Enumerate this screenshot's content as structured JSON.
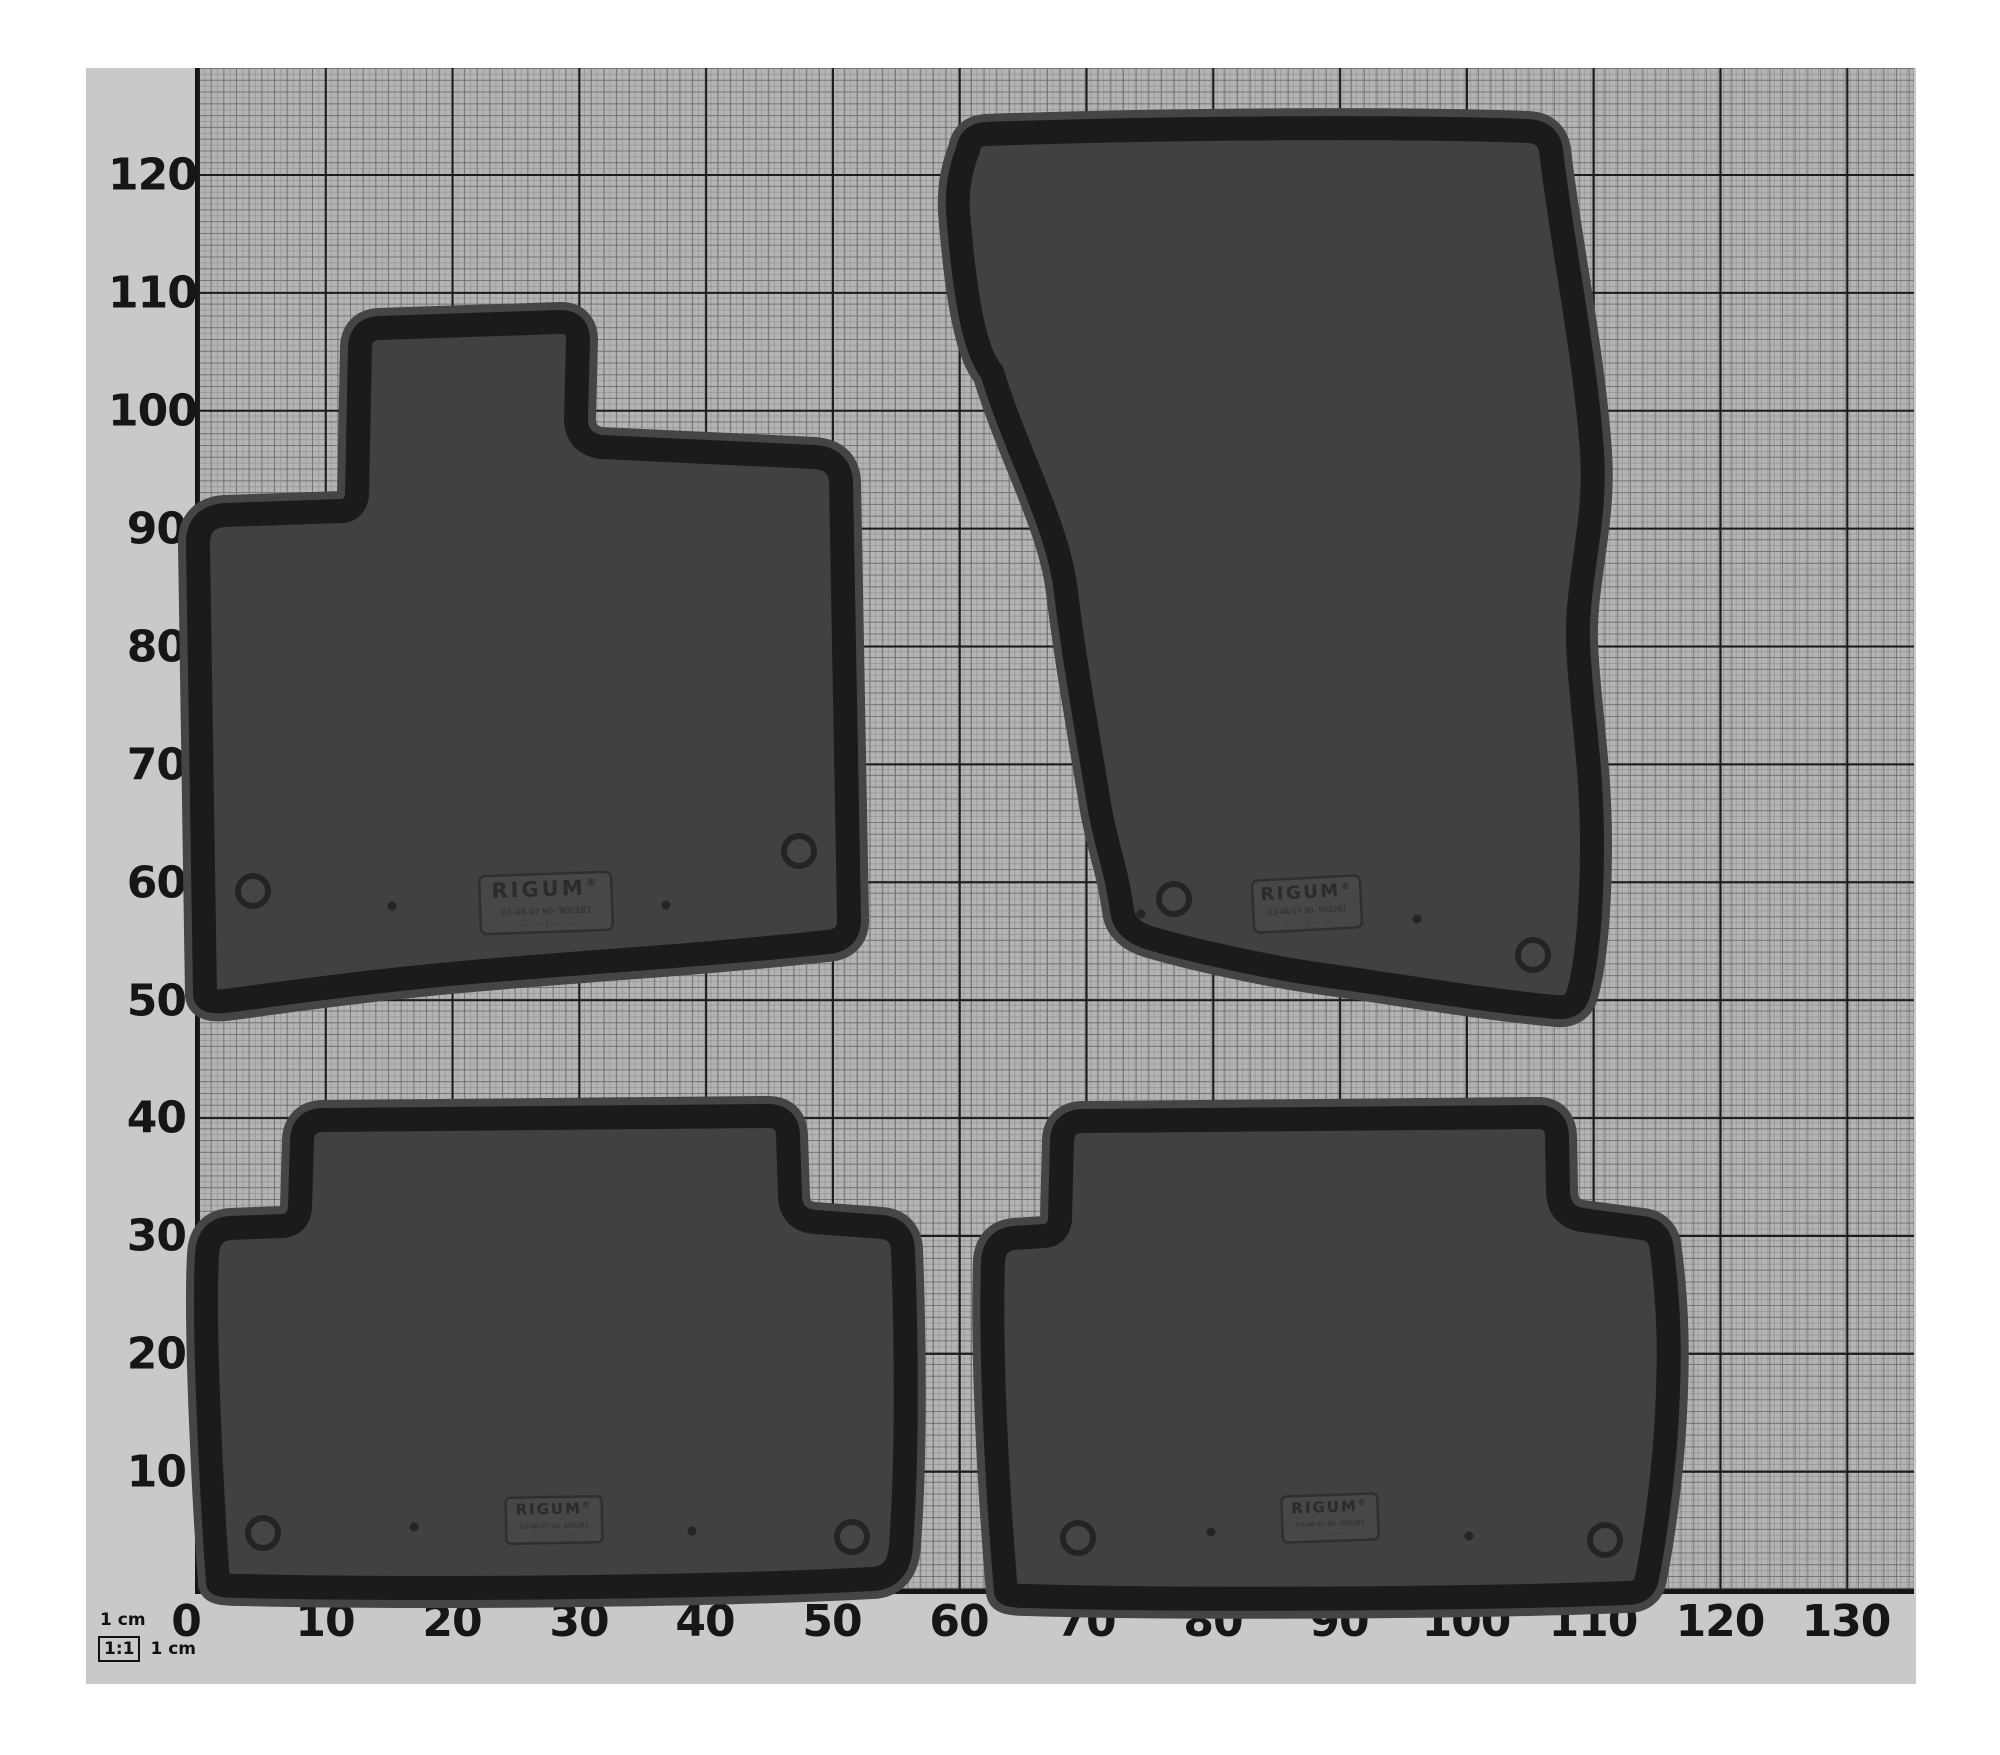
{
  "axis": {
    "x": [
      "0",
      "10",
      "20",
      "30",
      "40",
      "50",
      "60",
      "70",
      "80",
      "90",
      "100",
      "110",
      "120",
      "130"
    ],
    "y": [
      "120",
      "110",
      "100",
      "90",
      "80",
      "70",
      "60",
      "50",
      "40",
      "30",
      "20",
      "10"
    ]
  },
  "scale": {
    "top_label": "1 cm",
    "ratio": "1:1",
    "side_label": "1 cm"
  },
  "mats": [
    {
      "name": "front-left-mat",
      "label": {
        "brand": "RIGUM",
        "reg": "®",
        "code": "03-48-07  90-  900281",
        "info": "····· ···· / ····· ····"
      }
    },
    {
      "name": "front-right-mat",
      "label": {
        "brand": "RIGUM",
        "reg": "®",
        "code": "03-48-07  90-  900281",
        "info": "····· ···· / ····· ····"
      }
    },
    {
      "name": "rear-left-mat",
      "label": {
        "brand": "RIGUM",
        "reg": "®",
        "code": "03-48-07  90-  900281",
        "info": "····· ···· / ····· ····"
      }
    },
    {
      "name": "rear-right-mat",
      "label": {
        "brand": "RIGUM",
        "reg": "®",
        "code": "03-48-07  90-  900281",
        "info": "····· ···· / ····· ····"
      }
    }
  ],
  "colors": {
    "paper_grid": "#b4b4b4",
    "paper_margin": "#c9c9c9",
    "grid_major_line": "#1c1c1c",
    "mat_base": "#414141",
    "mat_cell": "#4e4e4e",
    "mat_groove": "#2d2d2d",
    "mat_rim": "#1b1b1b"
  }
}
